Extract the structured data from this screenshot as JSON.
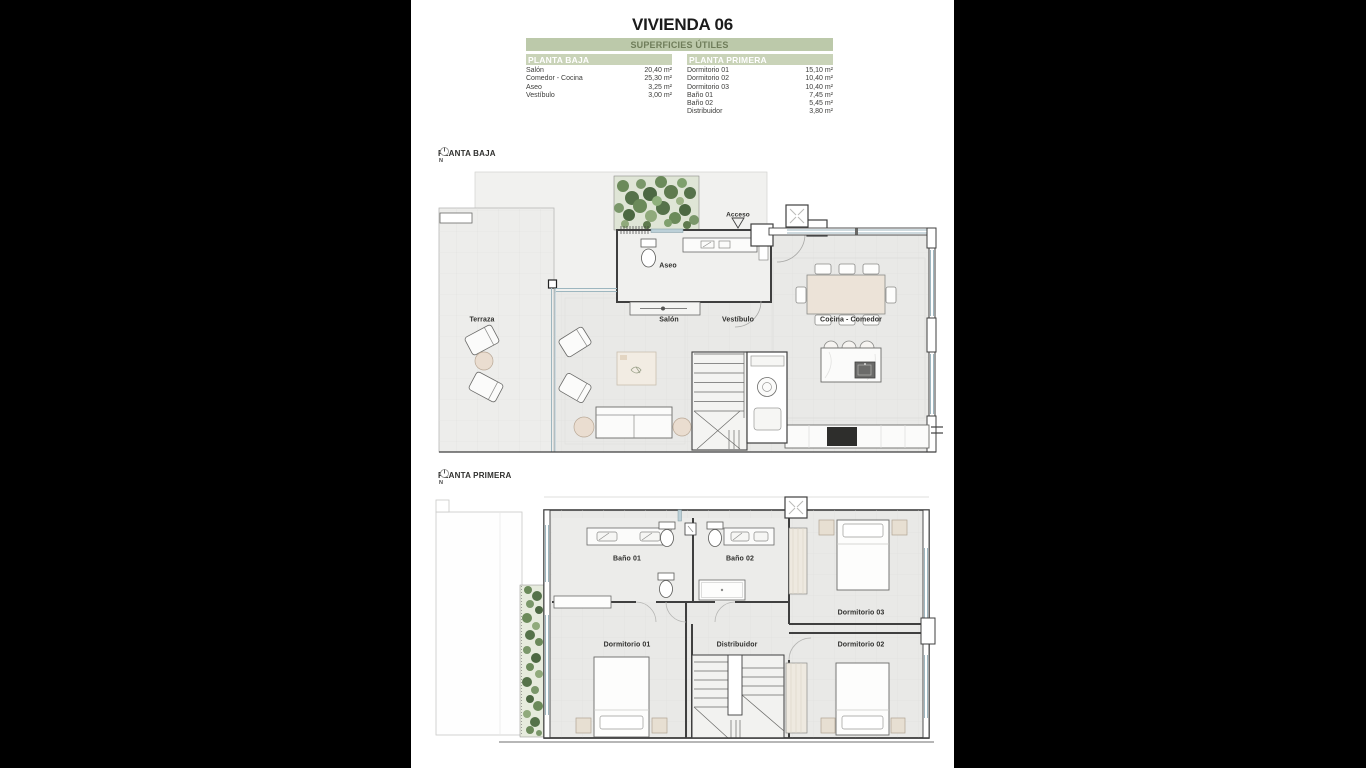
{
  "title": "VIVIENDA 06",
  "surface_table": {
    "header": "SUPERFICIES ÚTILES",
    "columns": [
      {
        "header": "PLANTA BAJA",
        "rows": [
          {
            "name": "Salón",
            "value": "20,40 m²"
          },
          {
            "name": "Comedor - Cocina",
            "value": "25,30 m²"
          },
          {
            "name": "Aseo",
            "value": "3,25 m²"
          },
          {
            "name": "Vestíbulo",
            "value": "3,00 m²"
          }
        ]
      },
      {
        "header": "PLANTA PRIMERA",
        "rows": [
          {
            "name": "Dormitorio 01",
            "value": "15,10 m²"
          },
          {
            "name": "Dormitorio 02",
            "value": "10,40 m²"
          },
          {
            "name": "Dormitorio 03",
            "value": "10,40 m²"
          },
          {
            "name": "Baño 01",
            "value": "7,45 m²"
          },
          {
            "name": "Baño 02",
            "value": "5,45 m²"
          },
          {
            "name": "Distribuidor",
            "value": "3,80 m²"
          }
        ]
      }
    ]
  },
  "plans": [
    {
      "label": "PLANTA BAJA",
      "compass": "N",
      "rooms": {
        "terraza": "Terraza",
        "salon": "Salón",
        "aseo": "Aseo",
        "vestibulo": "Vestíbulo",
        "cocina_comedor": "Cocina - Comedor",
        "acceso": "Acceso"
      }
    },
    {
      "label": "PLANTA PRIMERA",
      "compass": "N",
      "rooms": {
        "bano01": "Baño 01",
        "bano02": "Baño 02",
        "dormitorio01": "Dormitorio 01",
        "dormitorio02": "Dormitorio 02",
        "dormitorio03": "Dormitorio 03",
        "distribuidor": "Distribuidor"
      }
    }
  ],
  "colors": {
    "paper": "#ffffff",
    "background": "#000000",
    "accent_bar": "#bcc9aa",
    "accent_bar_light": "#c9d3b8",
    "accent_text": "#6f7d5a",
    "floor": "#e9e9e7",
    "wall": "#3f3f3f",
    "window": "#9db6bf",
    "greenery": "#6b8a5a"
  }
}
